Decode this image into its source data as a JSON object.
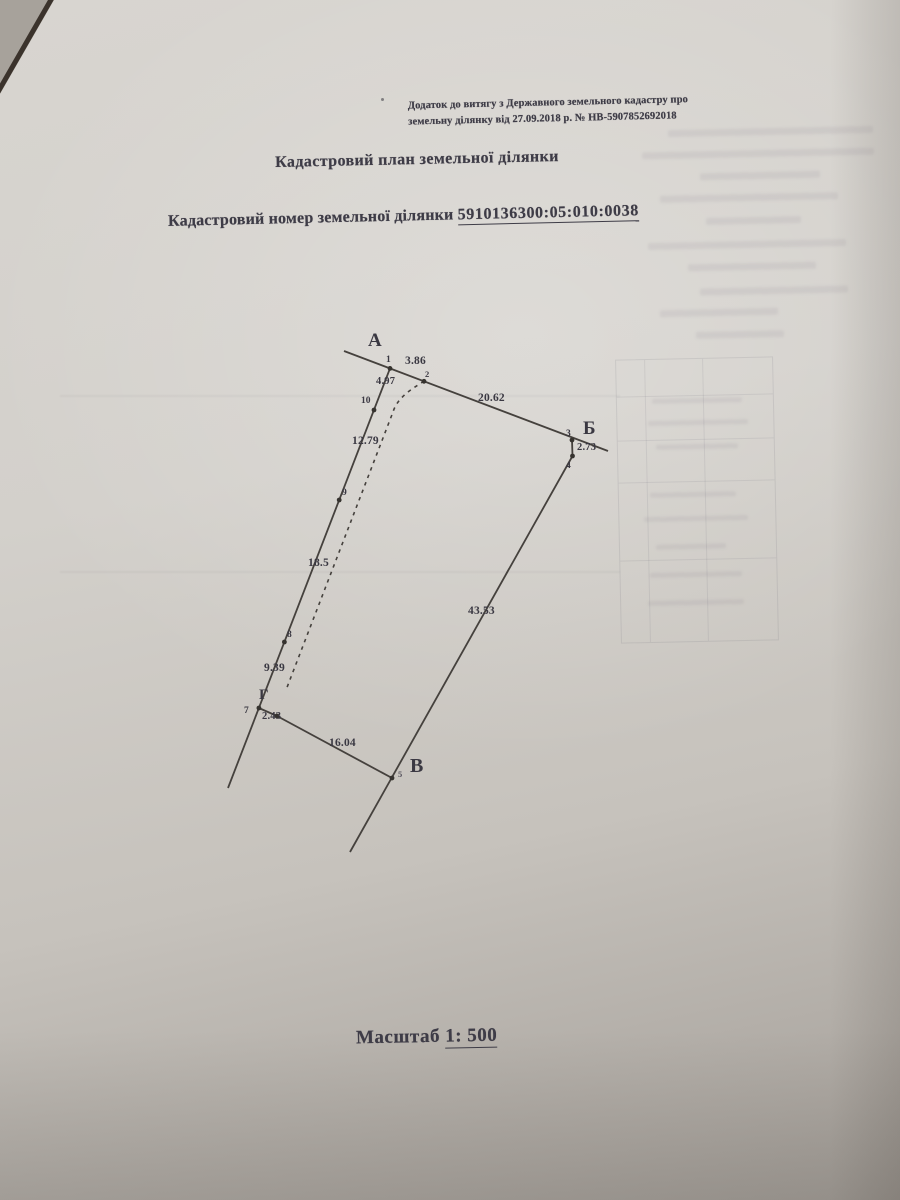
{
  "document": {
    "note_line1": "Додаток до витягу з Державного земельного кадастру про",
    "note_line2": "земельну ділянку від 27.09.2018 р. № НВ-5907852692018",
    "title": "Кадастровий план земельної ділянки",
    "parcel_number_label": "Кадастровий номер земельної ділянки",
    "parcel_number": "5910136300:05:010:0038",
    "scale_label": "Масштаб",
    "scale_value": "1: 500"
  },
  "plan": {
    "vertices": {
      "a": "А",
      "b": "Б",
      "v": "В",
      "g": "Г"
    },
    "point_numbers": {
      "p1": "1",
      "p2": "2",
      "p3": "3",
      "p4": "4",
      "p5": "5",
      "p7": "7",
      "p8": "8",
      "p9": "9",
      "p10": "10"
    },
    "segment_lengths": {
      "d_1_2": "3.86",
      "d_2_3": "20.62",
      "d_3_4": "2.73",
      "d_4_5": "43.53",
      "d_6_5": "16.04",
      "d_7_6": "2.43",
      "d_8_7": "9.39",
      "d_9_8": "18.5",
      "d_10_9": "12.79",
      "d_1_10": "4.97"
    },
    "ink_color": "#45413d",
    "paper_color": "#d3d0cb"
  }
}
